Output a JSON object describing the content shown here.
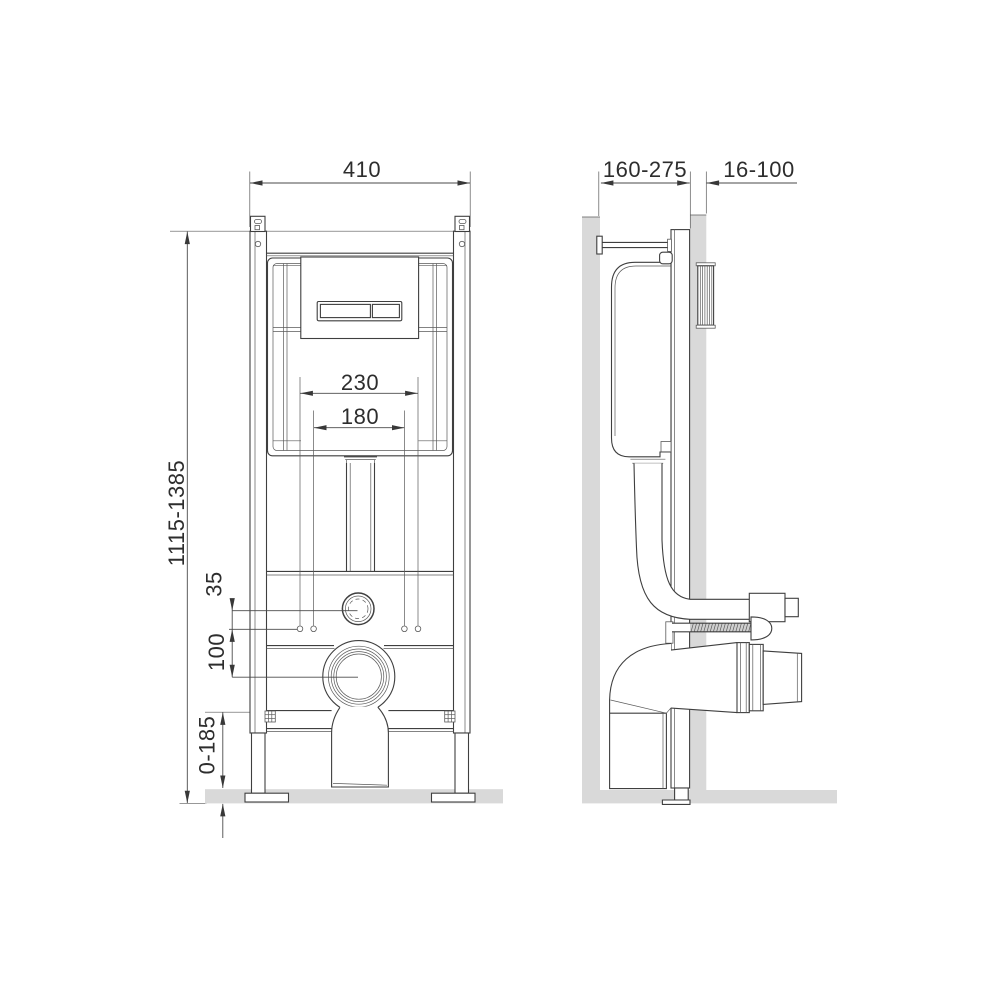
{
  "drawing": {
    "kind": "wc-installation-frame-dimensional-diagram",
    "views": {
      "left": "front-view",
      "right": "side-view"
    }
  },
  "dimensions": {
    "frame_width": "410",
    "frame_height": "1115-1385",
    "fixing_spacing_outer": "230",
    "fixing_spacing_inner": "180",
    "inlet_offset": "35",
    "outlet_offset": "100",
    "floor_adjust_range": "0-185",
    "install_depth_range": "160-275",
    "wall_finish_range": "16-100"
  },
  "colors": {
    "line": "#3f3f3f",
    "dimension_line": "#4a4a4a",
    "text": "#2d2d2d",
    "wall_floor_fill": "#d9d9d9"
  }
}
